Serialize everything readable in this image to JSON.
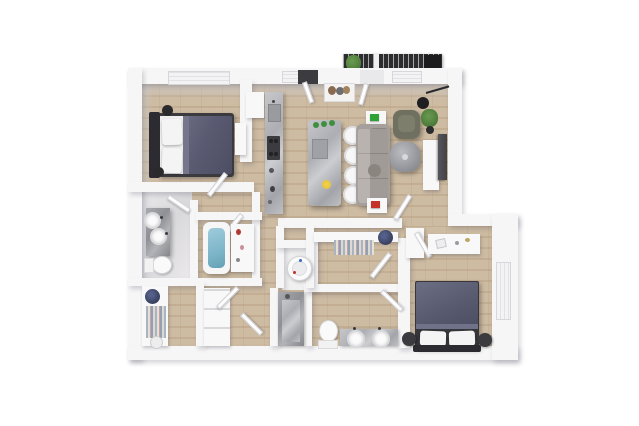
{
  "scene": {
    "type": "3d-floor-plan-rendering",
    "description": "Top-down 3D architectural rendering of a two-bedroom two-bathroom apartment with open kitchen/living area and balcony, on a plain white background",
    "visible_text": "none",
    "background": "#ffffff"
  },
  "palette": {
    "wall": "#f6f6f7",
    "wall_shadow": "#d9d9dd",
    "wood": "#c9b59a",
    "wood_dark": "#b5a083",
    "marble": "#b6b7bc",
    "marble_dark": "#97989d",
    "duvet": "#595a71",
    "headboard": "#2b2b31",
    "pillow": "#f4f4f5",
    "sofa": "#a6a09d",
    "sofa_back": "#b9b3b0",
    "armchair": "#6f705f",
    "balcony_floor": "#2d2d2f",
    "plant": "#4e7d3c",
    "tub_water": "#7db5c8",
    "accent_green": "#2fa236",
    "accent_red": "#c5322a",
    "accent_yellow": "#e9c53b",
    "accent_navy": "#3c4565",
    "appliance_dark": "#3b3b40",
    "tv": "#434347"
  },
  "rooms": [
    {
      "id": "bedroom-1",
      "position": "top-left"
    },
    {
      "id": "kitchen",
      "position": "top-center"
    },
    {
      "id": "living-dining",
      "position": "top-right"
    },
    {
      "id": "balcony",
      "position": "top-edge"
    },
    {
      "id": "bathroom-1",
      "position": "mid-left"
    },
    {
      "id": "tub-room",
      "position": "mid-center-left"
    },
    {
      "id": "walk-in-closet-1",
      "position": "bottom-left"
    },
    {
      "id": "hallway",
      "position": "center"
    },
    {
      "id": "utility-closet",
      "position": "center"
    },
    {
      "id": "bathroom-2",
      "position": "bottom-center"
    },
    {
      "id": "walk-in-closet-2",
      "position": "center-right"
    },
    {
      "id": "bedroom-2",
      "position": "bottom-right"
    }
  ],
  "furniture": {
    "bedroom_1": [
      "double-bed",
      "dark-headboard",
      "two-white-pillows",
      "slate-duvet",
      "two-black-bedside-accents",
      "small-dresser",
      "window-with-blinds"
    ],
    "kitchen": [
      "refrigerator",
      "marble-counter-with-sink",
      "dark-cooktop",
      "marble-island",
      "four-white-bar-stools",
      "green-plants-on-island",
      "yellow-flowers"
    ],
    "living_dining": [
      "gray-sectional-sofa",
      "side-table-with-green-book",
      "side-table-with-red-book",
      "olive-armchair",
      "round-marble-coffee-table",
      "white-tv-console",
      "wall-mounted-tv",
      "black-arc-floor-lamp",
      "potted-plant",
      "framed-wall-art",
      "entry-door",
      "balcony-door",
      "two-windows"
    ],
    "balcony": [
      "dark-deck-floor",
      "railing-slats",
      "planter",
      "dark-privacy-panel"
    ],
    "bathroom_1": [
      "marble-vanity",
      "two-round-sinks",
      "toilet"
    ],
    "tub_room": [
      "bathtub",
      "storage-ledge-with-toiletries"
    ],
    "walk_in_closet_1": [
      "wardrobe-shelves",
      "hanging-clothes",
      "navy-basket",
      "white-basket"
    ],
    "hallway": [
      "linen-shelf-unit",
      "swing-doors"
    ],
    "utility_closet": [
      "round-white-appliance"
    ],
    "bathroom_2": [
      "marble-walk-in-shower",
      "toilet",
      "marble-double-sink-vanity"
    ],
    "walk_in_closet_2": [
      "shelf-with-hanging-clothes",
      "navy-basket"
    ],
    "bedroom_2": [
      "double-bed",
      "dark-headboard",
      "two-white-pillows",
      "slate-duvet",
      "two-dark-round-nightstands",
      "white-desk",
      "storage-cabinet",
      "window"
    ]
  },
  "counts": {
    "bedrooms": 2,
    "bathrooms": 2,
    "bar_stools": 4,
    "beds": 2,
    "toilets": 2,
    "sinks_bath1": 2,
    "sinks_bath2": 2
  }
}
